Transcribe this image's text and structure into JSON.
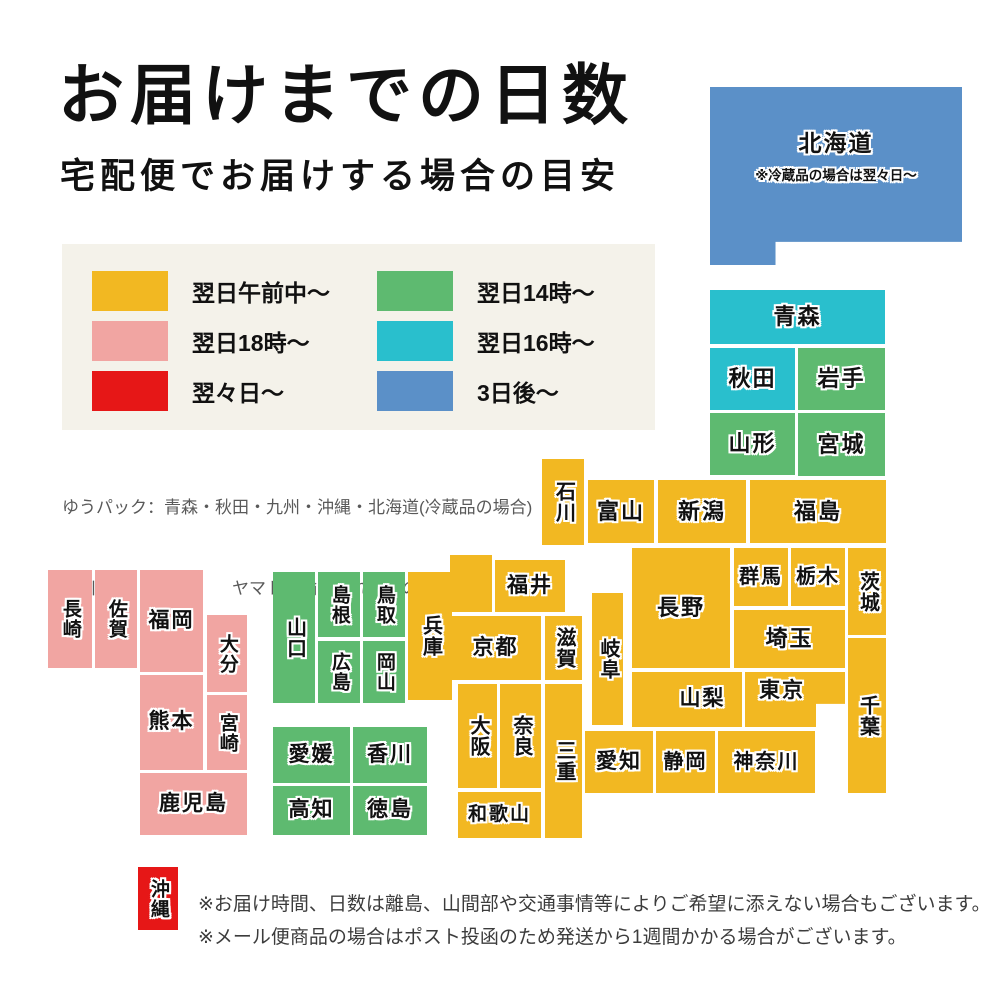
{
  "title": "お届けまでの日数",
  "subtitle": "宅配便でお届けする場合の目安",
  "colors": {
    "yellow": "#f2b822",
    "pink": "#f1a5a2",
    "red": "#e61717",
    "green": "#5eba70",
    "teal": "#29bfcd",
    "blue": "#5b90c8",
    "legend_bg": "#f4f2ea"
  },
  "legend": {
    "items": [
      {
        "key": "yellow",
        "label": "翌日午前中〜"
      },
      {
        "key": "pink",
        "label": "翌日18時〜"
      },
      {
        "key": "red",
        "label": "翌々日〜"
      },
      {
        "key": "green",
        "label": "翌日14時〜"
      },
      {
        "key": "teal",
        "label": "翌日16時〜"
      },
      {
        "key": "blue",
        "label": "3日後〜"
      }
    ]
  },
  "carriers": {
    "line1": "ゆうパック：青森・秋田・九州・沖縄・北海道(冷蔵品の場合)",
    "line2": "佐川急便：北海道　　ヤマト運輸：それ以外の都道府県"
  },
  "map": {
    "prefectures": [
      {
        "id": "hokkaido",
        "name": "北海道",
        "color": "blue",
        "rect": [
          710,
          87,
          252,
          178
        ],
        "dir": "h",
        "fs": 23,
        "clip": "polygon(0 0,100% 0,100% 87%,26% 87%,26% 100%,0 100%)",
        "note": "※冷蔵品の場合は翌々日〜"
      },
      {
        "id": "aomori",
        "name": "青森",
        "color": "teal",
        "rect": [
          710,
          290,
          175,
          54
        ],
        "dir": "h",
        "fs": 22
      },
      {
        "id": "akita",
        "name": "秋田",
        "color": "teal",
        "rect": [
          710,
          348,
          85,
          62
        ],
        "dir": "h",
        "fs": 22
      },
      {
        "id": "iwate",
        "name": "岩手",
        "color": "green",
        "rect": [
          798,
          348,
          87,
          62
        ],
        "dir": "h",
        "fs": 22
      },
      {
        "id": "yamagata",
        "name": "山形",
        "color": "green",
        "rect": [
          710,
          413,
          85,
          62
        ],
        "dir": "h",
        "fs": 22
      },
      {
        "id": "miyagi",
        "name": "宮城",
        "color": "green",
        "rect": [
          798,
          413,
          87,
          63
        ],
        "dir": "h",
        "fs": 22
      },
      {
        "id": "ishikawa",
        "name": "石川",
        "color": "yellow",
        "rect": [
          542,
          459,
          42,
          86
        ],
        "dir": "v",
        "fs": 20
      },
      {
        "id": "toyama",
        "name": "富山",
        "color": "yellow",
        "rect": [
          588,
          480,
          66,
          63
        ],
        "dir": "h",
        "fs": 22
      },
      {
        "id": "niigata",
        "name": "新潟",
        "color": "yellow",
        "rect": [
          658,
          480,
          88,
          63
        ],
        "dir": "h",
        "fs": 22
      },
      {
        "id": "fukushima",
        "name": "福島",
        "color": "yellow",
        "rect": [
          750,
          480,
          136,
          63
        ],
        "dir": "h",
        "fs": 22
      },
      {
        "id": "gunma",
        "name": "群馬",
        "color": "yellow",
        "rect": [
          734,
          548,
          54,
          58
        ],
        "dir": "h",
        "fs": 20
      },
      {
        "id": "tochigi",
        "name": "栃木",
        "color": "yellow",
        "rect": [
          791,
          548,
          54,
          58
        ],
        "dir": "h",
        "fs": 20
      },
      {
        "id": "ibaraki",
        "name": "茨城",
        "color": "yellow",
        "rect": [
          848,
          548,
          38,
          87
        ],
        "dir": "v",
        "fs": 20
      },
      {
        "id": "saitama",
        "name": "埼玉",
        "color": "yellow",
        "rect": [
          734,
          610,
          111,
          58
        ],
        "dir": "h",
        "fs": 22
      },
      {
        "id": "chiba",
        "name": "千葉",
        "color": "yellow",
        "rect": [
          848,
          638,
          38,
          155
        ],
        "dir": "v",
        "fs": 20
      },
      {
        "id": "tokyo",
        "name": "東京",
        "color": "yellow",
        "rect": [
          745,
          672,
          100,
          55
        ],
        "dir": "h",
        "fs": 21,
        "clip": "polygon(0 0,100% 0,100% 58%,71% 58%,71% 100%,0 100%)",
        "pad": "0 26px 16px 0"
      },
      {
        "id": "yamanashi",
        "name": "山梨",
        "color": "yellow",
        "rect": [
          663,
          672,
          79,
          55
        ],
        "dir": "h",
        "fs": 21
      },
      {
        "id": "kanagawa",
        "name": "神奈川",
        "color": "yellow",
        "rect": [
          718,
          731,
          97,
          62
        ],
        "dir": "h",
        "fs": 20
      },
      {
        "id": "shizuoka",
        "name": "静岡",
        "color": "yellow",
        "rect": [
          656,
          731,
          59,
          62
        ],
        "dir": "h",
        "fs": 20
      },
      {
        "id": "aichi",
        "name": "愛知",
        "color": "yellow",
        "rect": [
          585,
          731,
          68,
          62
        ],
        "dir": "h",
        "fs": 21
      },
      {
        "id": "nagano",
        "name": "長野",
        "color": "yellow",
        "rect": [
          632,
          548,
          98,
          120
        ],
        "dir": "h",
        "fs": 22
      },
      {
        "id": "nagano-south",
        "name": "",
        "color": "yellow",
        "rect": [
          632,
          672,
          40,
          55
        ],
        "dir": "h"
      },
      {
        "id": "gifu",
        "name": "岐阜",
        "color": "yellow",
        "rect": [
          592,
          593,
          31,
          132
        ],
        "dir": "v",
        "fs": 20
      },
      {
        "id": "fukui",
        "name": "福井",
        "color": "yellow",
        "rect": [
          495,
          560,
          70,
          52
        ],
        "dir": "h",
        "fs": 21
      },
      {
        "id": "kyoto-north",
        "name": "",
        "color": "yellow",
        "rect": [
          450,
          555,
          42,
          57
        ],
        "dir": "h"
      },
      {
        "id": "shiga",
        "name": "滋賀",
        "color": "yellow",
        "rect": [
          545,
          616,
          37,
          64
        ],
        "dir": "v",
        "fs": 20
      },
      {
        "id": "kyoto",
        "name": "京都",
        "color": "yellow",
        "rect": [
          450,
          616,
          91,
          64
        ],
        "dir": "h",
        "fs": 21
      },
      {
        "id": "osaka",
        "name": "大阪",
        "color": "yellow",
        "rect": [
          458,
          684,
          39,
          104
        ],
        "dir": "v",
        "fs": 20
      },
      {
        "id": "nara",
        "name": "奈良",
        "color": "yellow",
        "rect": [
          500,
          684,
          41,
          104
        ],
        "dir": "v",
        "fs": 20
      },
      {
        "id": "mie",
        "name": "三重",
        "color": "yellow",
        "rect": [
          545,
          684,
          37,
          154
        ],
        "dir": "v",
        "fs": 20
      },
      {
        "id": "wakayama",
        "name": "和歌山",
        "color": "yellow",
        "rect": [
          458,
          792,
          83,
          46
        ],
        "dir": "h",
        "fs": 19
      },
      {
        "id": "hyogo",
        "name": "兵庫",
        "color": "yellow",
        "rect": [
          408,
          572,
          44,
          128
        ],
        "dir": "v",
        "fs": 20
      },
      {
        "id": "tottori",
        "name": "鳥取",
        "color": "green",
        "rect": [
          363,
          572,
          42,
          65
        ],
        "dir": "v",
        "fs": 19
      },
      {
        "id": "okayama",
        "name": "岡山",
        "color": "green",
        "rect": [
          363,
          641,
          42,
          62
        ],
        "dir": "v",
        "fs": 19
      },
      {
        "id": "shimane",
        "name": "島根",
        "color": "green",
        "rect": [
          318,
          572,
          42,
          65
        ],
        "dir": "v",
        "fs": 19
      },
      {
        "id": "hiroshima",
        "name": "広島",
        "color": "green",
        "rect": [
          318,
          641,
          42,
          62
        ],
        "dir": "v",
        "fs": 19
      },
      {
        "id": "yamaguchi",
        "name": "山口",
        "color": "green",
        "rect": [
          273,
          572,
          42,
          131
        ],
        "dir": "v",
        "fs": 20
      },
      {
        "id": "ehime",
        "name": "愛媛",
        "color": "green",
        "rect": [
          273,
          727,
          77,
          56
        ],
        "dir": "h",
        "fs": 21
      },
      {
        "id": "kagawa",
        "name": "香川",
        "color": "green",
        "rect": [
          353,
          727,
          74,
          56
        ],
        "dir": "h",
        "fs": 21
      },
      {
        "id": "kochi",
        "name": "高知",
        "color": "green",
        "rect": [
          273,
          786,
          77,
          49
        ],
        "dir": "h",
        "fs": 21
      },
      {
        "id": "tokushima",
        "name": "徳島",
        "color": "green",
        "rect": [
          353,
          786,
          74,
          49
        ],
        "dir": "h",
        "fs": 21
      },
      {
        "id": "nagasaki",
        "name": "長崎",
        "color": "pink",
        "rect": [
          48,
          570,
          44,
          98
        ],
        "dir": "v",
        "fs": 19
      },
      {
        "id": "saga",
        "name": "佐賀",
        "color": "pink",
        "rect": [
          95,
          570,
          42,
          98
        ],
        "dir": "v",
        "fs": 19
      },
      {
        "id": "fukuoka",
        "name": "福岡",
        "color": "pink",
        "rect": [
          140,
          570,
          63,
          102
        ],
        "dir": "h",
        "fs": 21
      },
      {
        "id": "oita",
        "name": "大分",
        "color": "pink",
        "rect": [
          207,
          615,
          40,
          77
        ],
        "dir": "v",
        "fs": 19
      },
      {
        "id": "kumamoto",
        "name": "熊本",
        "color": "pink",
        "rect": [
          140,
          675,
          63,
          95
        ],
        "dir": "h",
        "fs": 21
      },
      {
        "id": "miyazaki",
        "name": "宮崎",
        "color": "pink",
        "rect": [
          207,
          695,
          40,
          75
        ],
        "dir": "v",
        "fs": 19
      },
      {
        "id": "kagoshima",
        "name": "鹿児島",
        "color": "pink",
        "rect": [
          140,
          773,
          107,
          62
        ],
        "dir": "h",
        "fs": 21
      },
      {
        "id": "okinawa",
        "name": "沖縄",
        "color": "red",
        "rect": [
          138,
          867,
          40,
          63
        ],
        "dir": "v",
        "fs": 19
      }
    ]
  },
  "notes": [
    "※お届け時間、日数は離島、山間部や交通事情等によりご希望に添えない場合もございます。",
    "※メール便商品の場合はポスト投函のため発送から1週間かかる場合がございます。"
  ]
}
